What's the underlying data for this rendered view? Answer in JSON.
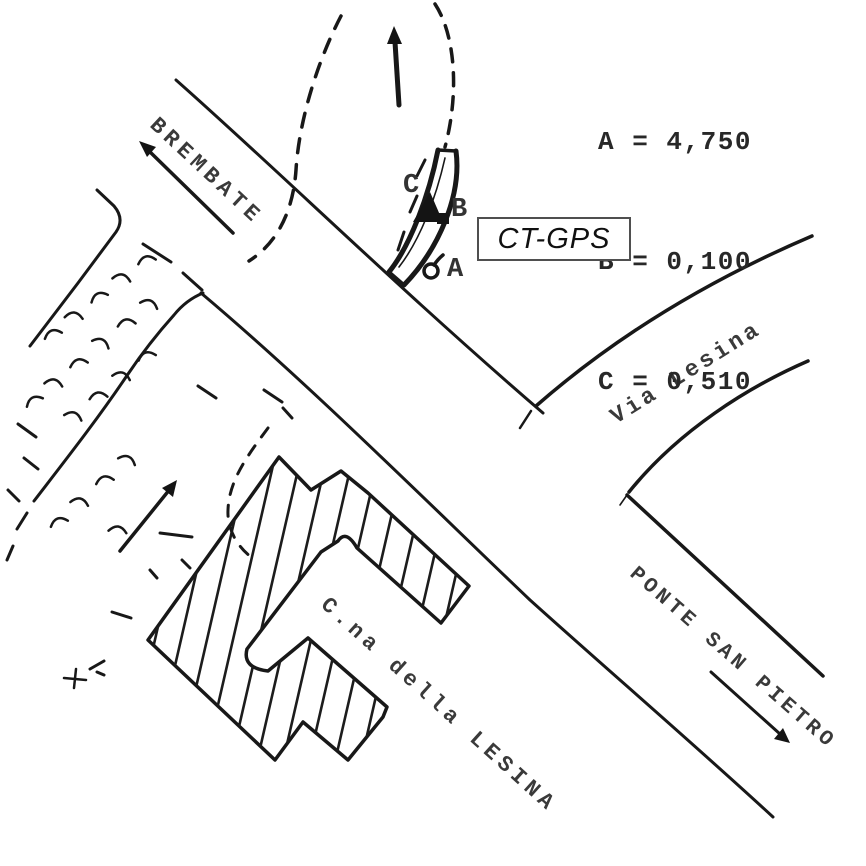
{
  "labels": {
    "road_brembate": "BREMBATE",
    "road_via_lesina": "Via Lesina",
    "road_ponte_san_pietro": "PONTE SAN PIETRO",
    "building": "C.na della LESINA",
    "station": "CT-GPS"
  },
  "point_markers": {
    "a": "A",
    "b": "B",
    "c": "C"
  },
  "measurements": [
    {
      "label": "A",
      "value": "4,750",
      "text": "A = 4,750"
    },
    {
      "label": "B",
      "value": "0,100",
      "text": "B = 0,100"
    },
    {
      "label": "C",
      "value": "0,510",
      "text": "C = 0,510"
    }
  ],
  "colors": {
    "ink": "#181818",
    "label_text": "#3a3a3a",
    "paper": "#ffffff"
  }
}
